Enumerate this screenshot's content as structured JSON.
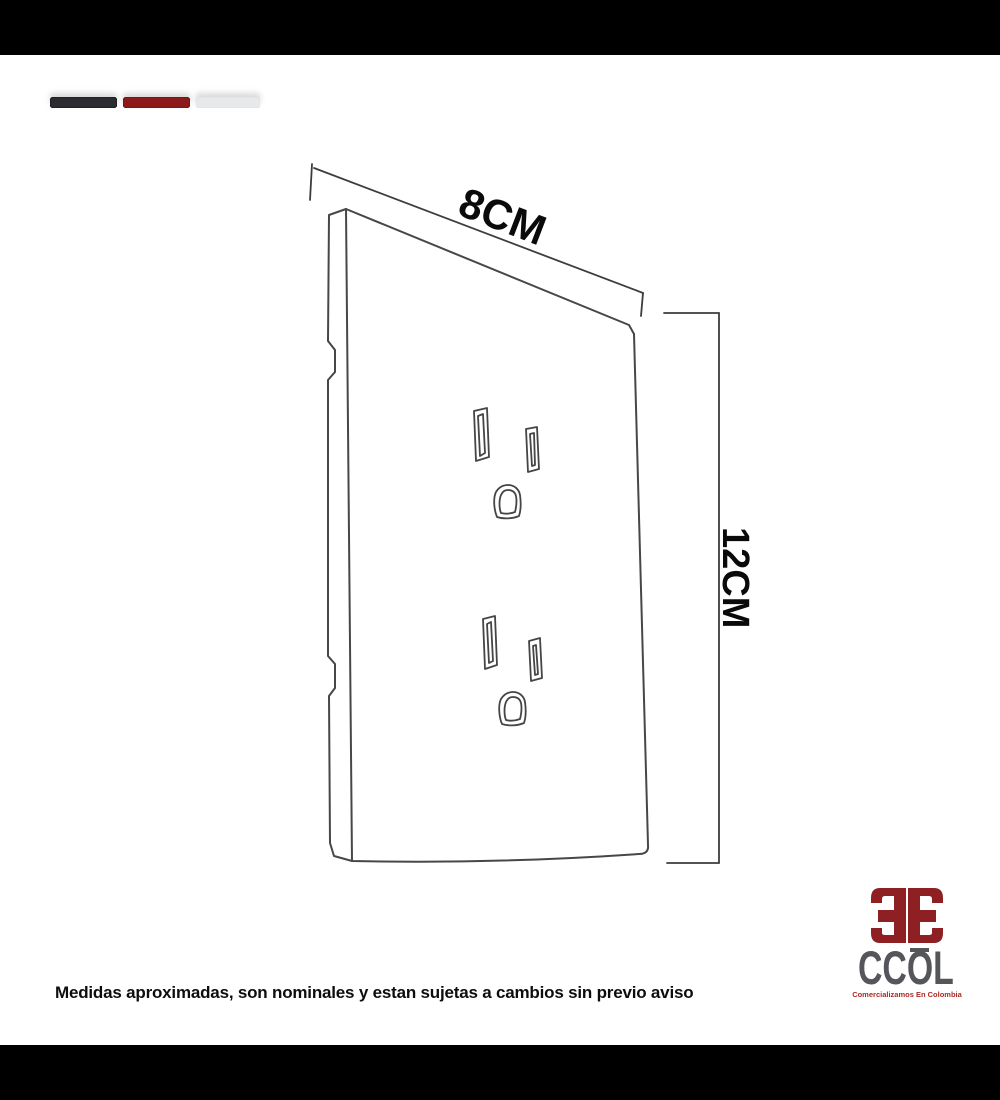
{
  "frame": {
    "top_bar_color": "#000000",
    "bottom_bar_color": "#000000"
  },
  "palette": {
    "swatches": [
      {
        "name": "dark-charcoal",
        "color": "#2b2b31"
      },
      {
        "name": "dark-red",
        "color": "#8c1a1a"
      },
      {
        "name": "light-gray",
        "color": "#e7e9ea"
      }
    ]
  },
  "diagram": {
    "subject": "outlet-cover-plate",
    "width_label": "8CM",
    "height_label": "12CM",
    "line_color": "#474747",
    "label_color": "#0a0a0a"
  },
  "footer": {
    "disclaimer": "Medidas aproximadas, son nominales y estan sujetas a cambios sin previo aviso"
  },
  "logo": {
    "monogram": "CC",
    "name": "CCOL",
    "tagline": "Comercializamos En Colombia",
    "emblem_color": "#8e1f22",
    "name_color": "#54565a",
    "tagline_color": "#ab2a24"
  }
}
